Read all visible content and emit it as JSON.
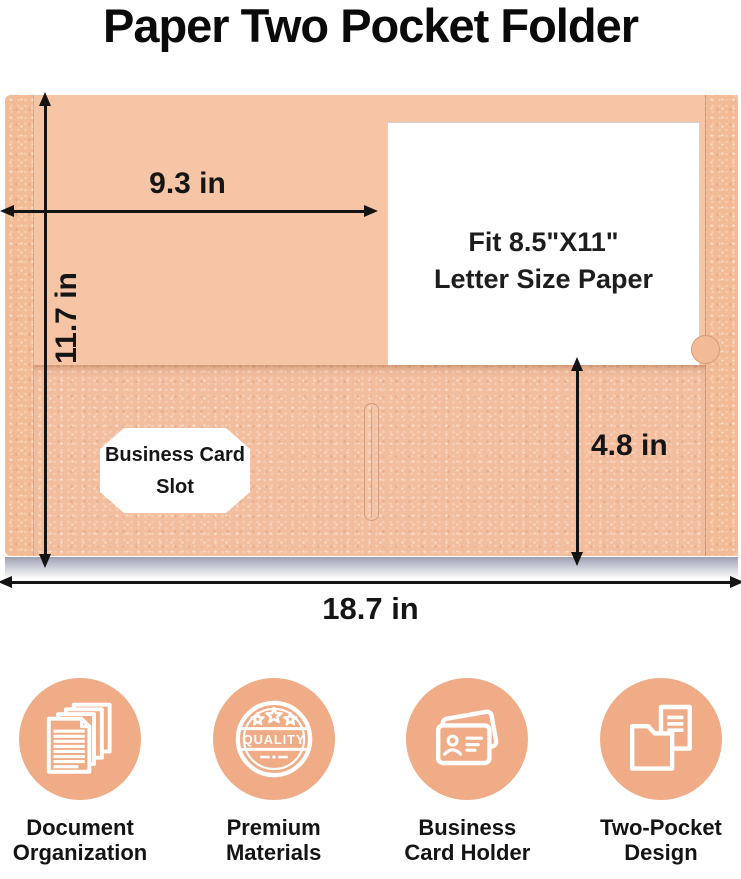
{
  "title": "Paper Two Pocket Folder",
  "colors": {
    "folder_body": "#F6C5A5",
    "folder_pocket": "#F3BE9E",
    "folder_spine": "#F2BB96",
    "icon_circle": "#EFAC86",
    "arrow": "#141414"
  },
  "folder": {
    "paper_text_line1": "Fit 8.5\"X11\"",
    "paper_text_line2": "Letter Size Paper",
    "card_slot_line1": "Business Card",
    "card_slot_line2": "Slot"
  },
  "dimensions": {
    "top_width": "9.3  in",
    "left_height": "11.7 in",
    "pocket_height": "4.8 in",
    "bottom_width": "18.7 in"
  },
  "features": [
    {
      "icon": "documents-icon",
      "label_line1": "Document",
      "label_line2": "Organization"
    },
    {
      "icon": "quality-badge-icon",
      "label_line1": "Premium",
      "label_line2": "Materials",
      "badge_text": "QUALITY"
    },
    {
      "icon": "business-card-icon",
      "label_line1": "Business",
      "label_line2": "Card Holder"
    },
    {
      "icon": "two-pocket-folder-icon",
      "label_line1": "Two-Pocket",
      "label_line2": "Design"
    }
  ]
}
